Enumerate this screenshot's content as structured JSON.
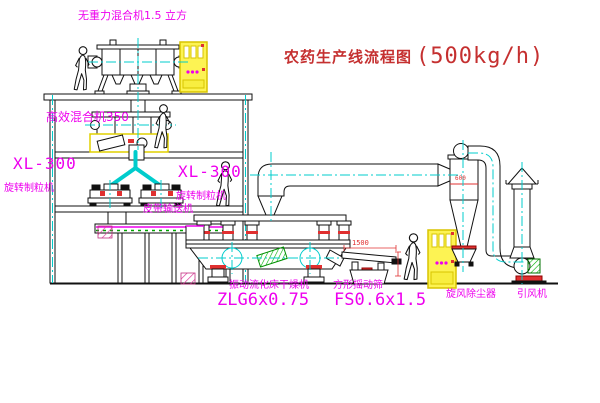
{
  "title": {
    "text_cn": "农药生产线流程图",
    "capacity": "(500kg/h)"
  },
  "labels": {
    "gravity_free_mixer": "无重力混合机1.5 立方",
    "high_efficiency_mixer": "高效混合机350",
    "granulator_left_model": "XL-300",
    "granulator_left_name": "旋转制粒机",
    "granulator_right_model": "XL-300",
    "granulator_right_name": "旋转制粒机",
    "belt_conveyor": "皮带输送机",
    "dryer_name": "振动流化床干燥机",
    "dryer_model": "ZLG6x0.75",
    "sieve_name": "方形摇动筛",
    "sieve_model": "FS0.6x1.5",
    "cyclone_name": "旋风除尘器",
    "fan_name": "引风机"
  },
  "dimensions": {
    "sieve_length": "1500",
    "cyclone_diameter": "600"
  },
  "colors": {
    "label_magenta": "#ee00ee",
    "title_red": "#c53030",
    "centerline_cyan": "#00cccc",
    "accent_red": "#e03030",
    "cabinet_yellow": "#fdf353",
    "motor_green": "#00b000"
  }
}
